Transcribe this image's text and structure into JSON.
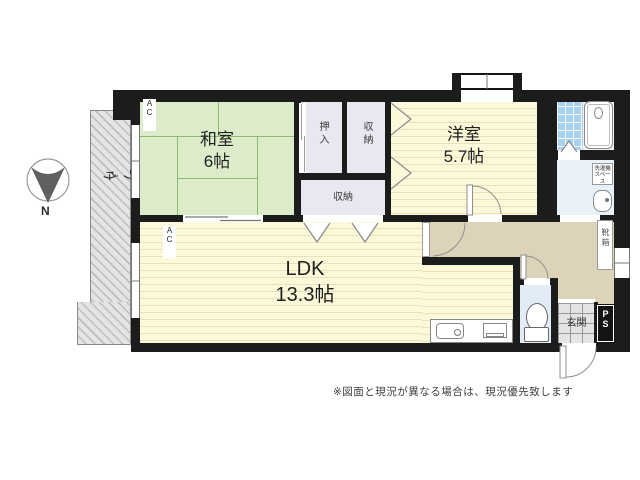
{
  "note": "※図面と現況が異なる場合は、現況優先致します",
  "compass": {
    "north_label": "N"
  },
  "balcony": {
    "label": "ベランダ"
  },
  "rooms": {
    "japanese_room": {
      "name": "和室",
      "size": "6帖"
    },
    "western_room": {
      "name": "洋室",
      "size": "5.7帖"
    },
    "ldk": {
      "name": "LDK",
      "size": "13.3帖"
    },
    "oshiire_closet": {
      "label": "押入"
    },
    "storage_upper": {
      "label": "収納"
    },
    "storage_lower": {
      "label": "収納"
    },
    "entrance": {
      "label": "玄関"
    },
    "pipe_space": {
      "label": "P\nS"
    },
    "shoe_box": {
      "label": "靴箱"
    },
    "laundry_space": {
      "label": "洗濯機\nスペース"
    }
  },
  "labels": {
    "ac_unit": "A\nC"
  },
  "colors": {
    "wall": "#1c1c1c",
    "tatami_green": "#dcecca",
    "room_yellow": "#fcf8da",
    "closet_lavender": "#eae7f0",
    "hall_beige": "#ddd3b9",
    "bath_blue": "#a9d2ee",
    "wet_floor": "#e8f1f8"
  }
}
